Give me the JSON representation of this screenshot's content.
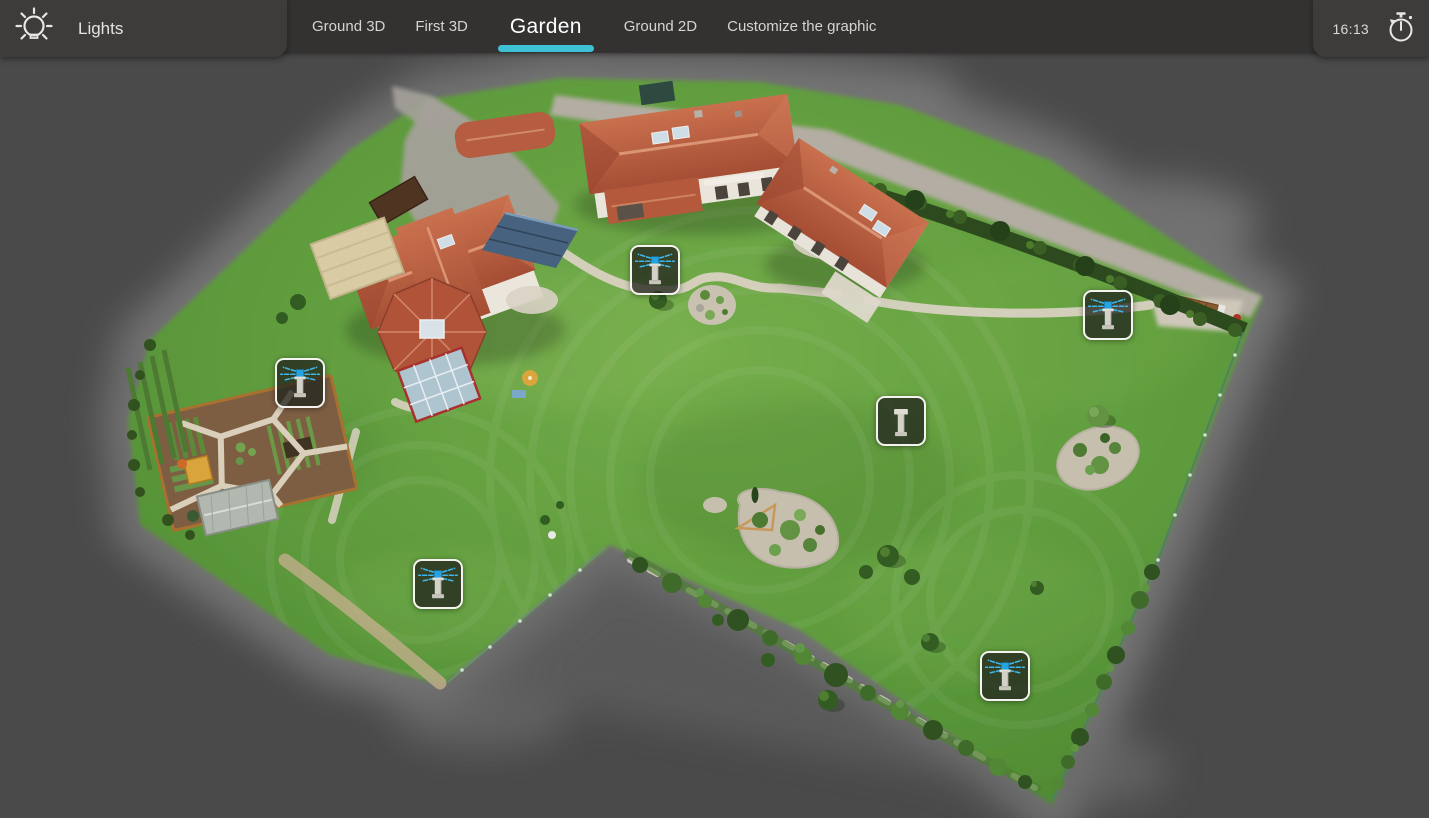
{
  "header": {
    "panel": {
      "icon": "lightbulb-icon",
      "title": "Lights"
    },
    "tabs": [
      {
        "label": "Ground 3D",
        "active": false
      },
      {
        "label": "First 3D",
        "active": false
      },
      {
        "label": "Garden",
        "active": true
      },
      {
        "label": "Ground 2D",
        "active": false
      },
      {
        "label": "Customize the graphic",
        "active": false
      }
    ],
    "clock": {
      "time": "16:13",
      "icon": "stopwatch-icon"
    }
  },
  "colors": {
    "accent": "#3ec1d5",
    "topbar": "#333231",
    "panel": "#3d3c3b",
    "map_background": "#4a4a4b",
    "sprinkler_spray": "#3fb6ea"
  },
  "map": {
    "view": "Garden aerial 3D model",
    "sprinklers": [
      {
        "id": "sprinkler-1",
        "x": 630,
        "y": 245,
        "state": "on"
      },
      {
        "id": "sprinkler-2",
        "x": 1083,
        "y": 290,
        "state": "on"
      },
      {
        "id": "sprinkler-3",
        "x": 275,
        "y": 358,
        "state": "on"
      },
      {
        "id": "sprinkler-4",
        "x": 876,
        "y": 396,
        "state": "off"
      },
      {
        "id": "sprinkler-5",
        "x": 413,
        "y": 559,
        "state": "on"
      },
      {
        "id": "sprinkler-6",
        "x": 980,
        "y": 651,
        "state": "on"
      }
    ]
  }
}
